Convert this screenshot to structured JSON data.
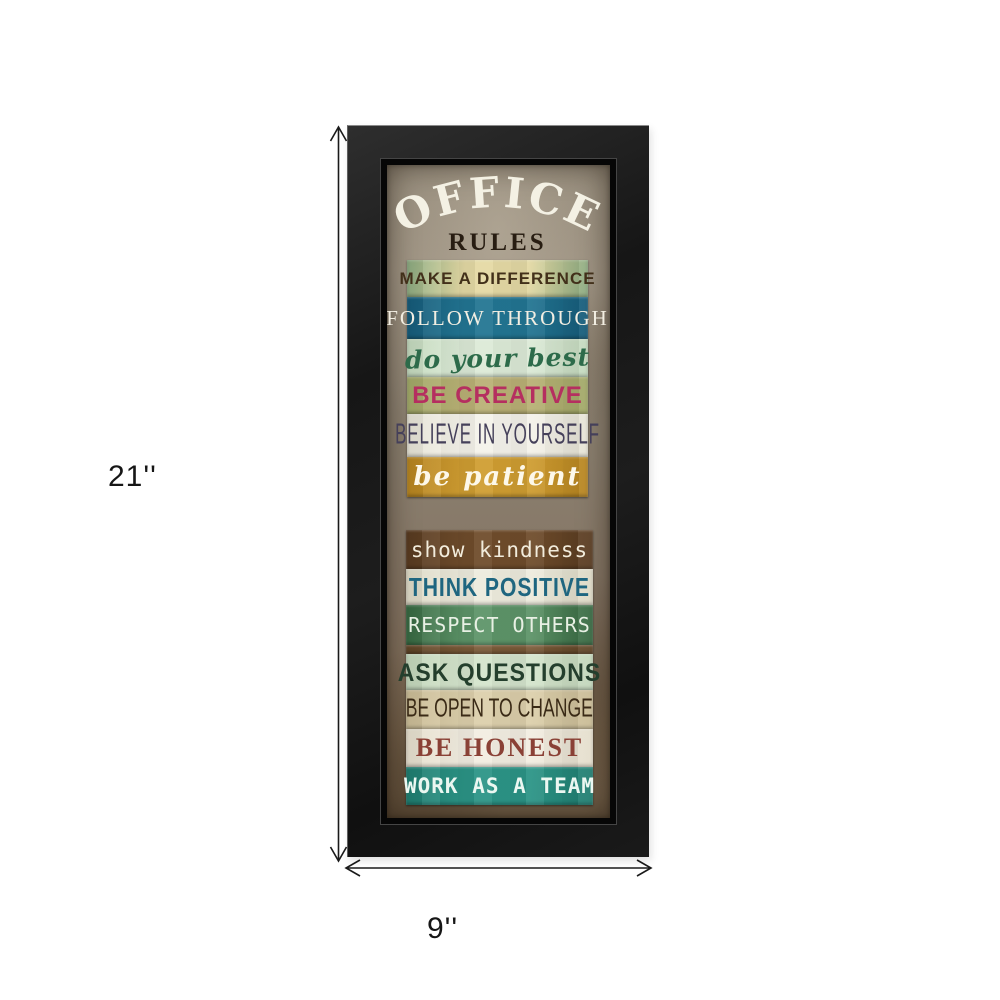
{
  "page": {
    "background": "#ffffff"
  },
  "artwork": {
    "frame_color": "#1a1a1a",
    "print_background": "#8b8070",
    "title": "OFFICE",
    "title_color": "#f4f1e4",
    "subtitle": "RULES",
    "subtitle_color": "#281d12",
    "rules": [
      {
        "label": "MAKE A DIFFERENCE",
        "bg": "#e4d9a4",
        "bg2": "#8aa97f",
        "fg": "#42301a"
      },
      {
        "label": "FOLLOW THROUGH",
        "bg": "#227592",
        "bg2": "#155a78",
        "fg": "#f2eee2"
      },
      {
        "label": "do your best",
        "bg": "#dcead7",
        "bg2": "#c2d8bc",
        "fg": "#2d6b4a"
      },
      {
        "label": "BE CREATIVE",
        "bg": "#b9b075",
        "bg2": "#a0a867",
        "fg": "#b52f60"
      },
      {
        "label": "BELIEVE IN YOURSELF",
        "bg": "#f4f2ea",
        "bg2": "#e5e2d4",
        "fg": "#45405a"
      },
      {
        "label": "be patient",
        "bg": "#cf9d31",
        "bg2": "#b5831f",
        "fg": "#fdf8ea"
      },
      {
        "label": "show kindness",
        "bg": "#6f4c2b",
        "bg2": "#573a20",
        "fg": "#f2ecdc"
      },
      {
        "label": "THINK POSITIVE",
        "bg": "#edebdd",
        "bg2": "#dcd8c4",
        "fg": "#1f6680"
      },
      {
        "label": "RESPECT OTHERS",
        "bg": "#5d9468",
        "bg2": "#35663f",
        "fg": "#e8f0e4"
      },
      {
        "label": "",
        "bg": "#7b5b39",
        "bg2": "#5f4426",
        "fg": "#000000"
      },
      {
        "label": "ASK QUESTIONS",
        "bg": "#d4e4cc",
        "bg2": "#c2d6ba",
        "fg": "#243f2d"
      },
      {
        "label": "BE OPEN TO CHANGE",
        "bg": "#dccfab",
        "bg2": "#c8ba94",
        "fg": "#3a2a16"
      },
      {
        "label": "BE HONEST",
        "bg": "#f2ede1",
        "bg2": "#e4ddcb",
        "fg": "#8a4136"
      },
      {
        "label": "WORK AS A TEAM",
        "bg": "#2b9486",
        "bg2": "#1f7c6f",
        "fg": "#ebf7f1"
      }
    ]
  },
  "dimensions": {
    "height_label": "21''",
    "width_label": "9''",
    "line_color": "#1a1a1a"
  }
}
